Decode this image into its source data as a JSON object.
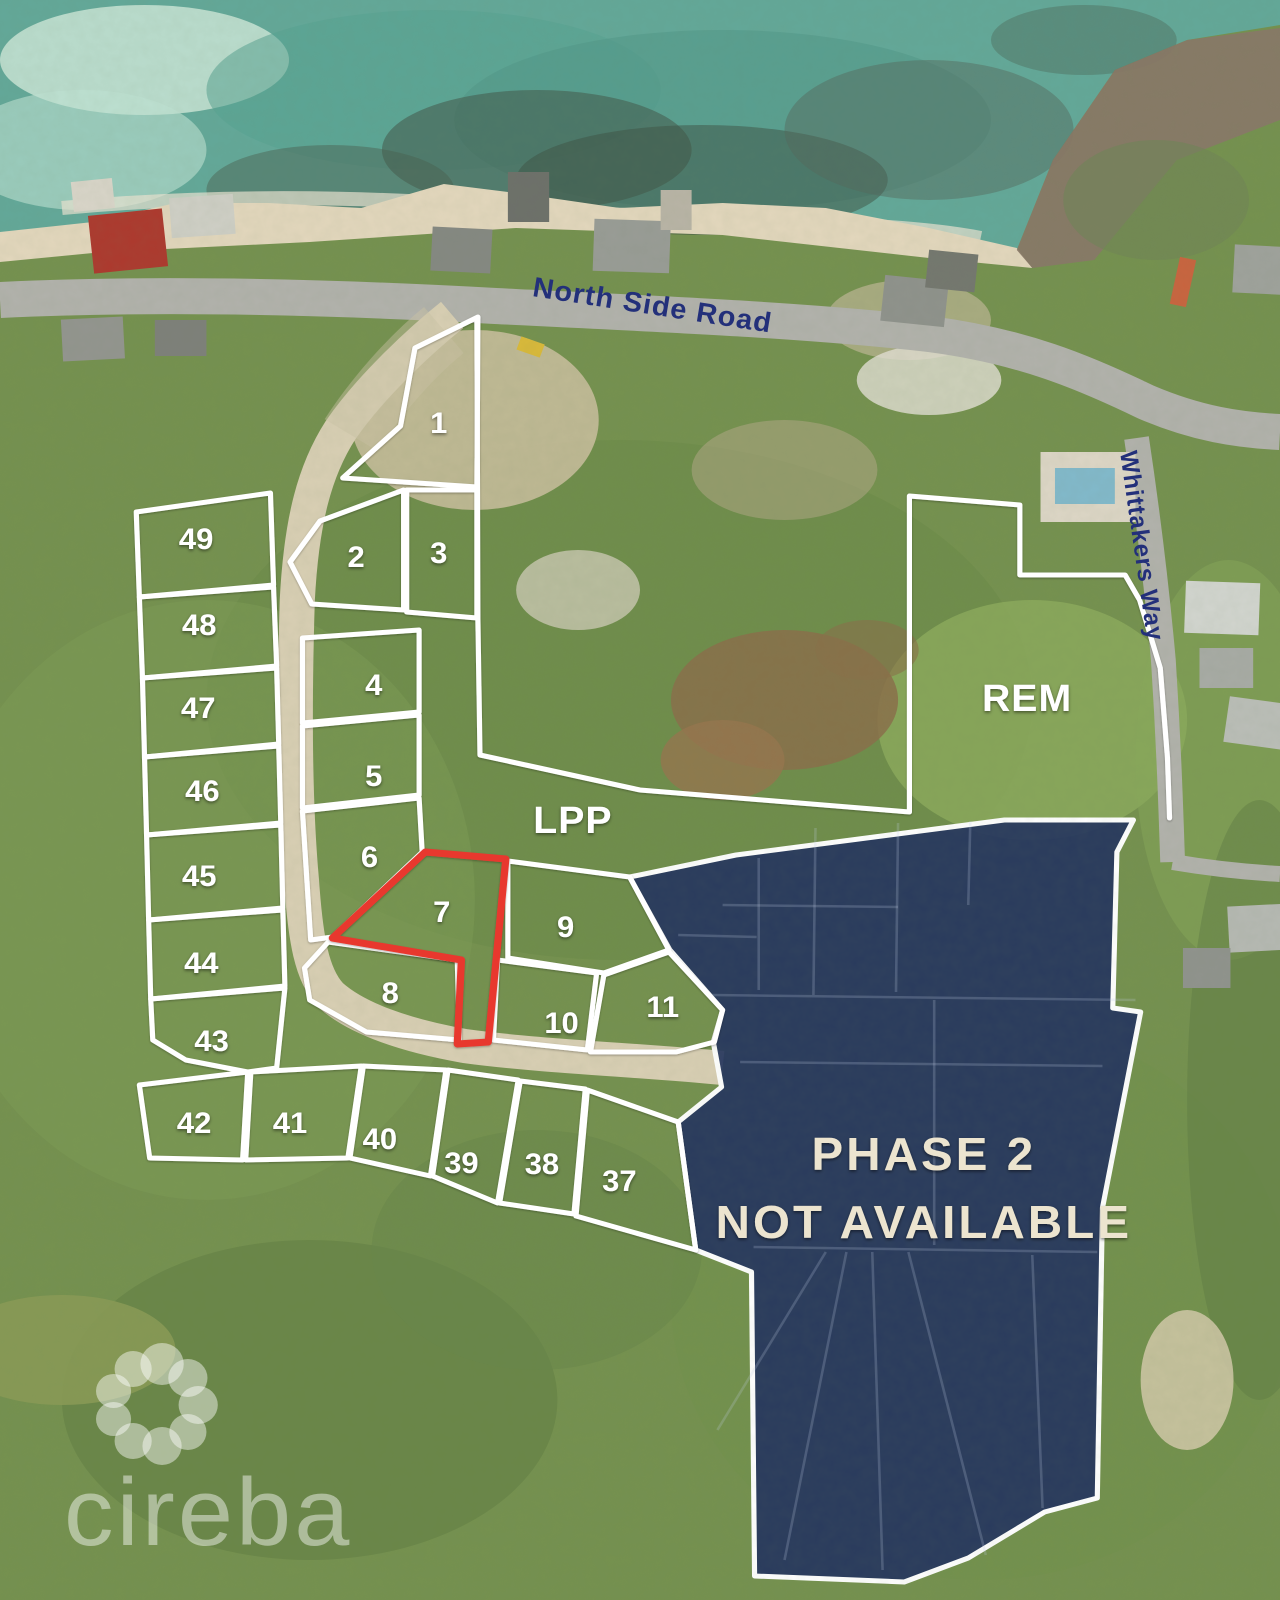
{
  "map": {
    "roads": {
      "north_side": "North Side Road",
      "whittakers": "Whittakers Way"
    },
    "regions": {
      "rem": "REM",
      "lpp": "LPP"
    },
    "phase2": {
      "line1": "PHASE 2",
      "line2": "NOT AVAILABLE"
    },
    "watermark": "cireba",
    "lots": [
      "1",
      "2",
      "3",
      "4",
      "5",
      "6",
      "7",
      "8",
      "9",
      "10",
      "11",
      "37",
      "38",
      "39",
      "40",
      "41",
      "42",
      "43",
      "44",
      "45",
      "46",
      "47",
      "48",
      "49"
    ],
    "colors": {
      "phase2_fill": "#24345e",
      "boundary": "#ffffff",
      "featured_lot": "#e8392f",
      "road_label": "#23307a",
      "sea": "#63a899",
      "land": "#75914f"
    }
  }
}
